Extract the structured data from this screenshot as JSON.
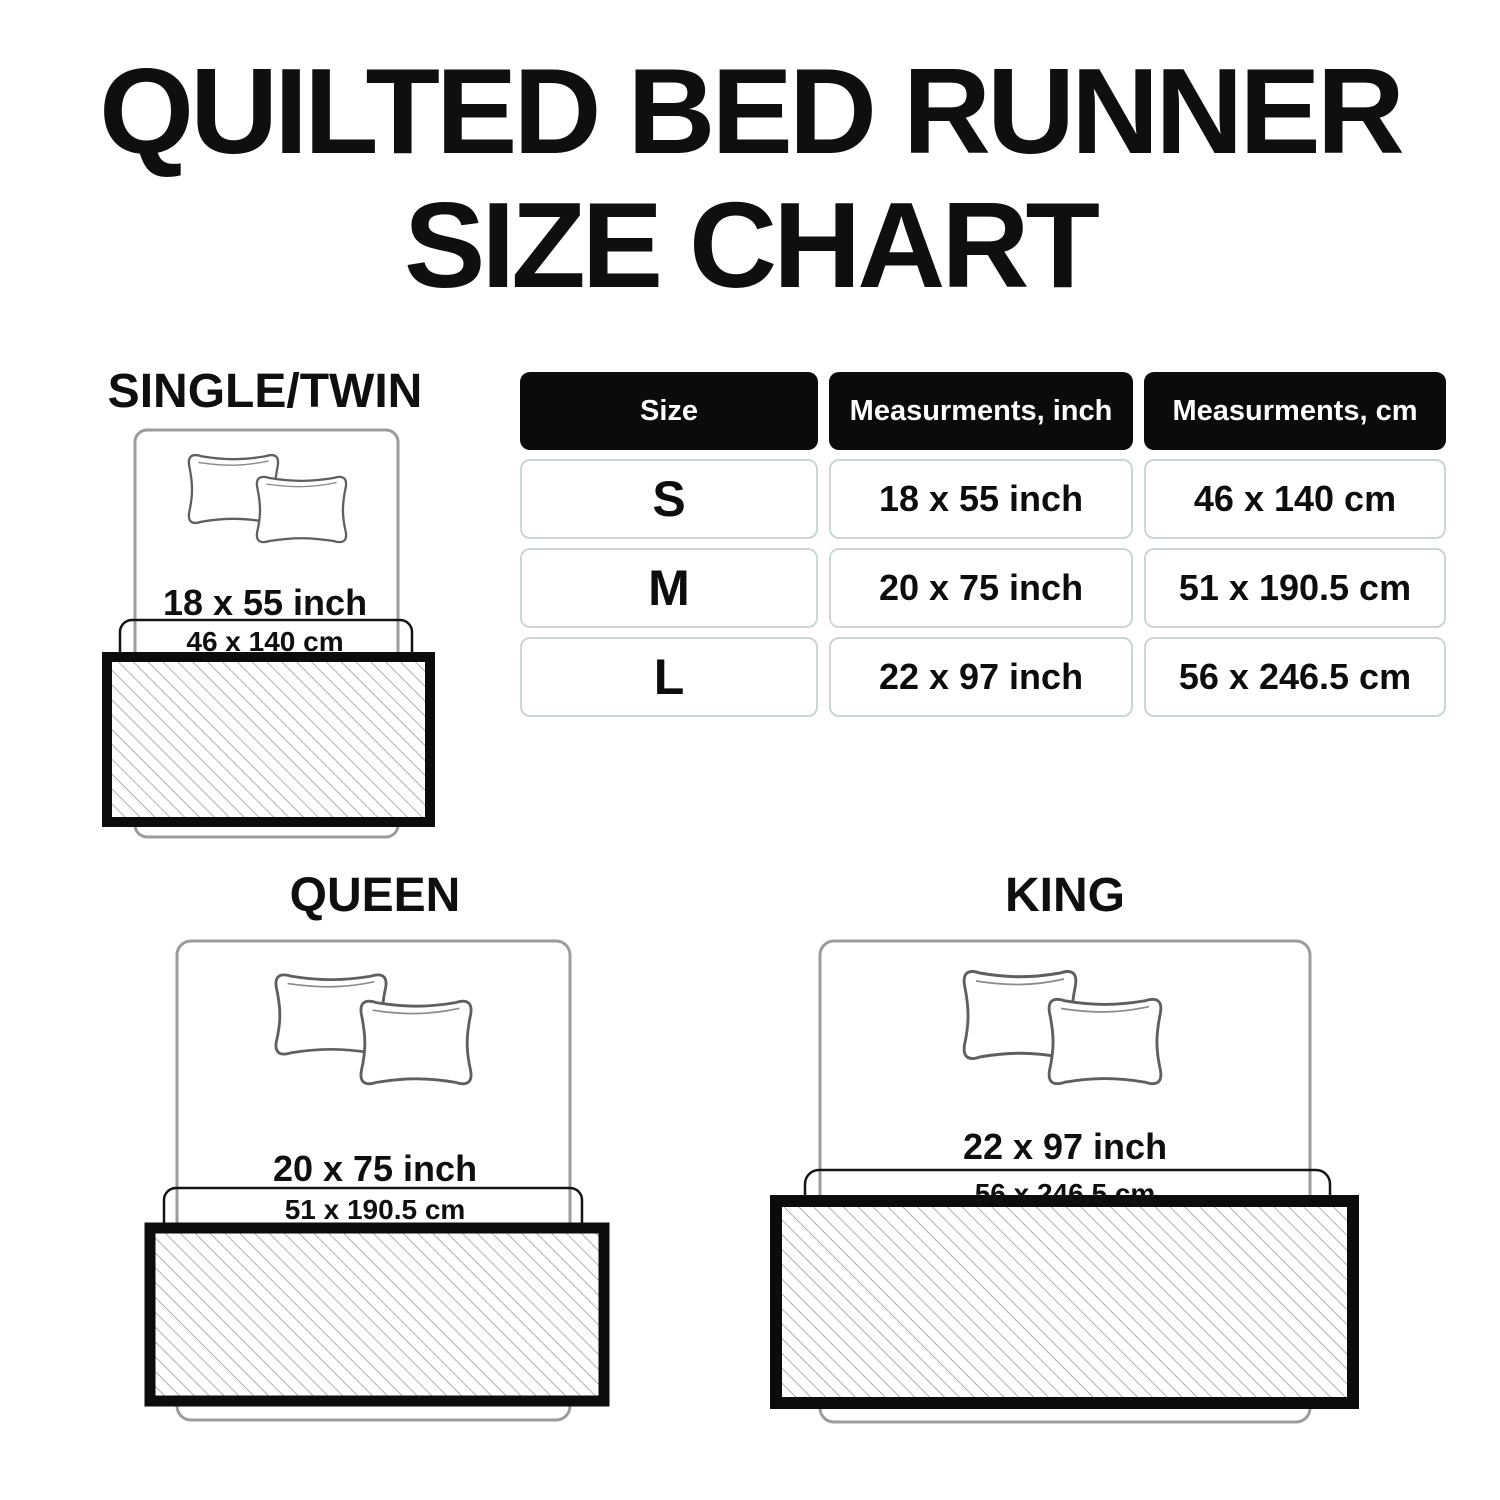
{
  "title": {
    "line1": "QUILTED BED RUNNER",
    "line2": "SIZE CHART"
  },
  "table": {
    "headers": {
      "size": "Size",
      "inch": "Measurments, inch",
      "cm": "Measurments, cm"
    },
    "rows": [
      {
        "size": "S",
        "inch": "18 x 55 inch",
        "cm": "46 x 140 cm"
      },
      {
        "size": "M",
        "inch": "20 x 75 inch",
        "cm": "51 x 190.5 cm"
      },
      {
        "size": "L",
        "inch": "22 x 97 inch",
        "cm": "56 x 246.5 cm"
      }
    ]
  },
  "diagrams": [
    {
      "label": "SINGLE/TWIN",
      "inch": "18 x 55 inch",
      "cm": "46 x 140 cm"
    },
    {
      "label": "QUEEN",
      "inch": "20 x 75 inch",
      "cm": "51 x 190.5 cm"
    },
    {
      "label": "KING",
      "inch": "22 x 97 inch",
      "cm": "56 x 246.5 cm"
    }
  ],
  "colors": {
    "text": "#0f0f0f",
    "header_bg": "#0b0b0b",
    "header_text": "#ffffff",
    "cell_border": "#ccd6d6",
    "bed_outline": "#9c9c9c",
    "pillow_outline": "#5f5f5f",
    "runner_border": "#0c0c0c",
    "runner_outline": "#141414",
    "hatch_line": "#8f8f8f"
  }
}
